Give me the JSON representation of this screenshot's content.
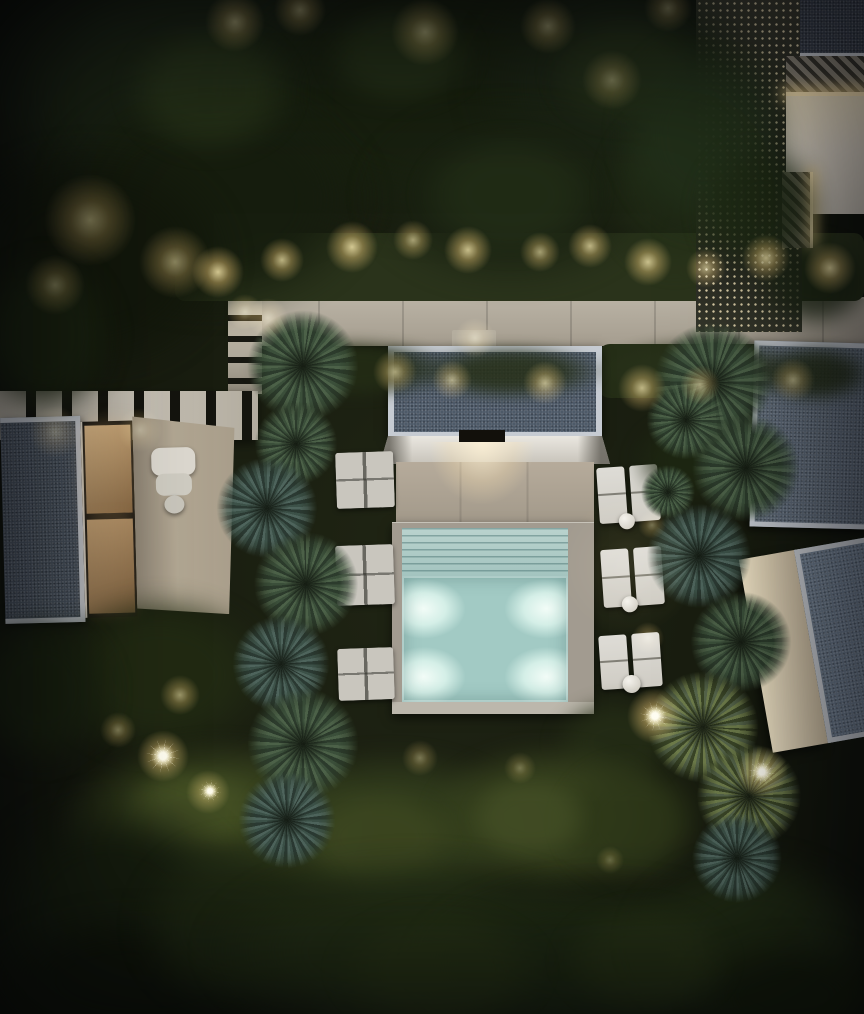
{
  "meta": {
    "title": "Night-time aerial render of a modern villa complex with illuminated pool",
    "width": 864,
    "height": 1014,
    "style": "photorealistic top-down architectural rendering, night scene"
  },
  "scene": {
    "elements": {
      "main_villa": "flat gravel roof with white border, entrance light, stone terrace and square pool with steps",
      "left_pavilion": "gravel roof, warm-lit glass rooms, beige patio with white outdoor sofa and stool",
      "right_pavilion_upper": "gravel roof with white border",
      "right_pavilion_lower": "angled pavilion with cream wall and gravel roof",
      "top_right_deck": "perforated lattice screen, diagonal slat canopies with LED strip lighting, warm terrace",
      "walkway": "light concrete path with hedge planting and warm garden uplights",
      "pergola": "slatted timber band beside left pavilion",
      "pool": "square pool, four underwater lights, tanning steps",
      "loungers": "three pairs of white sun loungers with round side tables on each side of the pool",
      "vegetation": "dense tree canopy, olive hedges, spiky palm clusters, garden spotlights"
    },
    "colors": {
      "path1": "#b9b2a4",
      "path2": "#a59d8f",
      "wallSlat": "#b0a99b",
      "pergola": "#c6c0b4",
      "slatDark": "#14140e",
      "lattice": "#23261d",
      "latticeDot": "#d8cba6",
      "terraceTR1": "#f1e4c5",
      "terraceTR2": "#c6c0b4",
      "ledGlow": "#ffe9b8",
      "roofGravel": "#4d5968",
      "roofGravelLeft": "#49535e",
      "roofGravelTR": "#3a414c",
      "roofGravelRU": "#5f6b79",
      "roofGravelRL": "#6e7d8e",
      "roofFrame": "#c6cbd2",
      "fascia1": "#eae7e0",
      "fascia2": "#c7c3ba",
      "terrace1": "#b6ab9b",
      "terrace2": "#a19889",
      "deck": "#a29b90",
      "deckRim": "#bcb7ac",
      "poolSteps1": "#bad3ce",
      "poolSteps2": "#a3c4bf",
      "poolWater": "#a2cac4",
      "poolGlow": "#f2fcf7",
      "loungerLight": "#dedcd6",
      "loungerDim": "#c9c6be",
      "creamWall": "#efe3c6",
      "interiorWarm1": "#e0bc8a",
      "interiorWarm2": "#8a6a45",
      "sofa": "#dcd8cf"
    },
    "pool": {
      "underwater_lights": 4,
      "steps_rows": 7
    },
    "canopies": [
      {
        "x": -40,
        "y": -60,
        "w": 480,
        "h": 320,
        "c": "#1b2414",
        "o": 1,
        "b": 14
      },
      {
        "x": 220,
        "y": -50,
        "w": 460,
        "h": 290,
        "c": "#18200f",
        "o": 1,
        "b": 14
      },
      {
        "x": 470,
        "y": -40,
        "w": 300,
        "h": 250,
        "c": "#1c2515",
        "o": 1,
        "b": 14
      },
      {
        "x": 40,
        "y": 80,
        "w": 340,
        "h": 240,
        "c": "#161d0e",
        "o": 0.95,
        "b": 12
      },
      {
        "x": 360,
        "y": 100,
        "w": 300,
        "h": 190,
        "c": "#1a2212",
        "o": 0.9,
        "b": 12
      },
      {
        "x": -60,
        "y": 140,
        "w": 300,
        "h": 240,
        "c": "#12170b",
        "o": 0.95,
        "b": 12
      },
      {
        "x": 120,
        "y": 20,
        "w": 180,
        "h": 140,
        "c": "#2e3c1d",
        "o": 0.55,
        "b": 8
      },
      {
        "x": 320,
        "y": 0,
        "w": 160,
        "h": 110,
        "c": "#2f3e1f",
        "o": 0.5,
        "b": 8
      },
      {
        "x": 545,
        "y": 10,
        "w": 160,
        "h": 120,
        "c": "#2b381c",
        "o": 0.5,
        "b": 8
      },
      {
        "x": 415,
        "y": 130,
        "w": 190,
        "h": 130,
        "c": "#27341a",
        "o": 0.55,
        "b": 8
      },
      {
        "x": 600,
        "y": 100,
        "w": 150,
        "h": 180,
        "c": "#243018",
        "o": 0.6,
        "b": 8
      },
      {
        "x": 615,
        "y": 30,
        "w": 180,
        "h": 210,
        "c": "#22301a",
        "o": 0.9,
        "b": 10
      },
      {
        "x": 695,
        "y": 140,
        "w": 130,
        "h": 140,
        "c": "#1e2a14",
        "o": 0.85,
        "b": 10
      },
      {
        "x": 755,
        "y": 235,
        "w": 120,
        "h": 95,
        "c": "#1c2613",
        "o": 0.8,
        "b": 8
      },
      {
        "x": -30,
        "y": 250,
        "w": 150,
        "h": 170,
        "c": "#1a2310",
        "o": 0.9,
        "b": 10
      },
      {
        "x": 245,
        "y": 338,
        "w": 210,
        "h": 62,
        "c": "#232c15",
        "o": 0.9,
        "b": 6
      },
      {
        "x": 415,
        "y": 344,
        "w": 190,
        "h": 56,
        "c": "#262f17",
        "o": 0.85,
        "b": 6
      },
      {
        "x": 595,
        "y": 338,
        "w": 210,
        "h": 64,
        "c": "#28311a",
        "o": 0.9,
        "b": 6
      },
      {
        "x": 755,
        "y": 344,
        "w": 120,
        "h": 60,
        "c": "#232c15",
        "o": 0.85,
        "b": 6
      },
      {
        "x": 630,
        "y": 415,
        "w": 120,
        "h": 90,
        "c": "#1f2913",
        "o": 0.75,
        "b": 8
      },
      {
        "x": 40,
        "y": 590,
        "w": 240,
        "h": 170,
        "c": "#222b13",
        "o": 0.9,
        "b": 10
      },
      {
        "x": -40,
        "y": 610,
        "w": 160,
        "h": 160,
        "c": "#1a2310",
        "o": 0.9,
        "b": 10
      },
      {
        "x": 550,
        "y": 695,
        "w": 130,
        "h": 95,
        "c": "#252e16",
        "o": 0.8,
        "b": 8
      },
      {
        "x": 55,
        "y": 735,
        "w": 330,
        "h": 185,
        "c": "#39441f",
        "o": 0.95,
        "b": 8
      },
      {
        "x": 235,
        "y": 745,
        "w": 310,
        "h": 175,
        "c": "#323d1d",
        "o": 0.9,
        "b": 8
      },
      {
        "x": 425,
        "y": 740,
        "w": 250,
        "h": 155,
        "c": "#39441f",
        "o": 0.9,
        "b": 8
      },
      {
        "x": 555,
        "y": 755,
        "w": 150,
        "h": 135,
        "c": "#2e3819",
        "o": 0.85,
        "b": 8
      },
      {
        "x": 120,
        "y": 765,
        "w": 150,
        "h": 95,
        "c": "#4c5828",
        "o": 0.6,
        "b": 6
      },
      {
        "x": 295,
        "y": 785,
        "w": 170,
        "h": 105,
        "c": "#454f24",
        "o": 0.55,
        "b": 6
      },
      {
        "x": 465,
        "y": 775,
        "w": 130,
        "h": 85,
        "c": "#4a552a",
        "o": 0.55,
        "b": 6
      },
      {
        "x": -30,
        "y": 790,
        "w": 290,
        "h": 250,
        "c": "#151c0e",
        "o": 1,
        "b": 12
      },
      {
        "x": -20,
        "y": 910,
        "w": 320,
        "h": 140,
        "c": "#10150a",
        "o": 1,
        "b": 12
      },
      {
        "x": 130,
        "y": 830,
        "w": 220,
        "h": 190,
        "c": "#1d2612",
        "o": 0.9,
        "b": 10
      },
      {
        "x": 200,
        "y": 850,
        "w": 430,
        "h": 200,
        "c": "#222d15",
        "o": 0.95,
        "b": 12
      },
      {
        "x": 410,
        "y": 875,
        "w": 380,
        "h": 170,
        "c": "#1e2913",
        "o": 0.95,
        "b": 12
      },
      {
        "x": 625,
        "y": 850,
        "w": 260,
        "h": 185,
        "c": "#202b14",
        "o": 0.95,
        "b": 12
      },
      {
        "x": 690,
        "y": 940,
        "w": 200,
        "h": 110,
        "c": "#161e0c",
        "o": 1,
        "b": 12
      },
      {
        "x": 330,
        "y": 905,
        "w": 220,
        "h": 130,
        "c": "#2a3517",
        "o": 0.6,
        "b": 8
      },
      {
        "x": 555,
        "y": 900,
        "w": 180,
        "h": 120,
        "c": "#2c3718",
        "o": 0.55,
        "b": 8
      }
    ],
    "palms": [
      {
        "x": 303,
        "y": 366,
        "r": 62,
        "t": "g",
        "a": 10
      },
      {
        "x": 296,
        "y": 444,
        "r": 46,
        "t": "g",
        "a": 80
      },
      {
        "x": 267,
        "y": 508,
        "r": 56,
        "t": "b",
        "a": 40
      },
      {
        "x": 306,
        "y": 584,
        "r": 58,
        "t": "g",
        "a": 0
      },
      {
        "x": 281,
        "y": 664,
        "r": 54,
        "t": "b",
        "a": 120
      },
      {
        "x": 303,
        "y": 744,
        "r": 62,
        "t": "g",
        "a": 60
      },
      {
        "x": 287,
        "y": 820,
        "r": 54,
        "t": "b",
        "a": 30
      },
      {
        "x": 713,
        "y": 382,
        "r": 66,
        "t": "g",
        "a": 20
      },
      {
        "x": 746,
        "y": 468,
        "r": 60,
        "t": "g",
        "a": 75
      },
      {
        "x": 699,
        "y": 556,
        "r": 58,
        "t": "b",
        "a": 140
      },
      {
        "x": 741,
        "y": 642,
        "r": 56,
        "t": "g",
        "a": 15
      },
      {
        "x": 703,
        "y": 727,
        "r": 62,
        "t": "w",
        "a": 95
      },
      {
        "x": 749,
        "y": 796,
        "r": 58,
        "t": "w",
        "a": 50
      },
      {
        "x": 737,
        "y": 858,
        "r": 50,
        "t": "b",
        "a": 160
      },
      {
        "x": 686,
        "y": 420,
        "r": 44,
        "t": "g",
        "a": 85
      },
      {
        "x": 668,
        "y": 492,
        "r": 30,
        "t": "g",
        "a": 130
      }
    ],
    "glows": [
      {
        "x": 218,
        "y": 272,
        "r": 26,
        "a": 0.8
      },
      {
        "x": 282,
        "y": 260,
        "r": 22,
        "a": 0.7
      },
      {
        "x": 352,
        "y": 247,
        "r": 26,
        "a": 0.8
      },
      {
        "x": 413,
        "y": 240,
        "r": 20,
        "a": 0.6
      },
      {
        "x": 468,
        "y": 250,
        "r": 24,
        "a": 0.75
      },
      {
        "x": 540,
        "y": 252,
        "r": 20,
        "a": 0.6
      },
      {
        "x": 590,
        "y": 246,
        "r": 22,
        "a": 0.7
      },
      {
        "x": 648,
        "y": 262,
        "r": 24,
        "a": 0.75
      },
      {
        "x": 706,
        "y": 268,
        "r": 20,
        "a": 0.65
      },
      {
        "x": 766,
        "y": 258,
        "r": 24,
        "a": 0.75
      },
      {
        "x": 830,
        "y": 268,
        "r": 26,
        "a": 0.8
      },
      {
        "x": 90,
        "y": 220,
        "r": 46,
        "a": 0.45
      },
      {
        "x": 175,
        "y": 262,
        "r": 36,
        "a": 0.5
      },
      {
        "x": 55,
        "y": 285,
        "r": 30,
        "a": 0.4
      },
      {
        "x": 235,
        "y": 22,
        "r": 30,
        "a": 0.5
      },
      {
        "x": 300,
        "y": 10,
        "r": 26,
        "a": 0.45
      },
      {
        "x": 425,
        "y": 32,
        "r": 34,
        "a": 0.5
      },
      {
        "x": 548,
        "y": 26,
        "r": 28,
        "a": 0.45
      },
      {
        "x": 612,
        "y": 80,
        "r": 30,
        "a": 0.4
      },
      {
        "x": 668,
        "y": 8,
        "r": 24,
        "a": 0.4
      },
      {
        "x": 268,
        "y": 318,
        "r": 20,
        "a": 0.55
      },
      {
        "x": 245,
        "y": 312,
        "r": 18,
        "a": 0.5
      },
      {
        "x": 395,
        "y": 372,
        "r": 22,
        "a": 0.6
      },
      {
        "x": 452,
        "y": 380,
        "r": 20,
        "a": 0.6
      },
      {
        "x": 545,
        "y": 383,
        "r": 22,
        "a": 0.65
      },
      {
        "x": 642,
        "y": 388,
        "r": 24,
        "a": 0.7
      },
      {
        "x": 700,
        "y": 385,
        "r": 20,
        "a": 0.6
      },
      {
        "x": 793,
        "y": 380,
        "r": 22,
        "a": 0.6
      },
      {
        "x": 475,
        "y": 338,
        "r": 20,
        "a": 0.5
      },
      {
        "x": 655,
        "y": 716,
        "r": 28,
        "a": 0.85
      },
      {
        "x": 762,
        "y": 772,
        "r": 26,
        "a": 0.8
      },
      {
        "x": 648,
        "y": 638,
        "r": 16,
        "a": 0.5
      },
      {
        "x": 652,
        "y": 525,
        "r": 14,
        "a": 0.4
      },
      {
        "x": 180,
        "y": 695,
        "r": 20,
        "a": 0.55
      },
      {
        "x": 163,
        "y": 756,
        "r": 26,
        "a": 0.8
      },
      {
        "x": 208,
        "y": 792,
        "r": 22,
        "a": 0.6
      },
      {
        "x": 118,
        "y": 730,
        "r": 18,
        "a": 0.45
      },
      {
        "x": 420,
        "y": 758,
        "r": 18,
        "a": 0.4
      },
      {
        "x": 520,
        "y": 768,
        "r": 16,
        "a": 0.35
      },
      {
        "x": 610,
        "y": 860,
        "r": 14,
        "a": 0.3
      },
      {
        "x": 55,
        "y": 432,
        "r": 26,
        "a": 0.45
      },
      {
        "x": 140,
        "y": 430,
        "r": 22,
        "a": 0.4
      },
      {
        "x": 628,
        "y": 565,
        "r": 70,
        "a": 0.12
      }
    ],
    "starbursts": [
      {
        "x": 163,
        "y": 756,
        "r": 18
      },
      {
        "x": 655,
        "y": 716,
        "r": 16
      },
      {
        "x": 762,
        "y": 772,
        "r": 15
      },
      {
        "x": 210,
        "y": 791,
        "r": 12
      }
    ],
    "lounger_groups_right": [
      {
        "x": 598,
        "y": 466,
        "w": 62,
        "h": 56,
        "rot": -4,
        "tx": 27,
        "ty": 55,
        "tr": 8
      },
      {
        "x": 602,
        "y": 548,
        "w": 62,
        "h": 58,
        "rot": -4,
        "tx": 26,
        "ty": 56,
        "tr": 8
      },
      {
        "x": 600,
        "y": 634,
        "w": 62,
        "h": 54,
        "rot": -4,
        "tx": 30,
        "ty": 50,
        "tr": 9
      }
    ],
    "lounger_pads_left": [
      {
        "x": 336,
        "y": 452,
        "w": 58,
        "h": 56,
        "rot": -2
      },
      {
        "x": 336,
        "y": 545,
        "w": 58,
        "h": 60,
        "rot": -2
      },
      {
        "x": 338,
        "y": 648,
        "w": 56,
        "h": 52,
        "rot": -2
      }
    ],
    "palm_palettes": {
      "g": [
        "#4c6148",
        "#2c3b2c",
        "#3b4f3a"
      ],
      "b": [
        "#4e645c",
        "#2b3a33",
        "#3c5148"
      ],
      "w": [
        "#6d7b4a",
        "#3a4527",
        "#55644a"
      ]
    }
  }
}
